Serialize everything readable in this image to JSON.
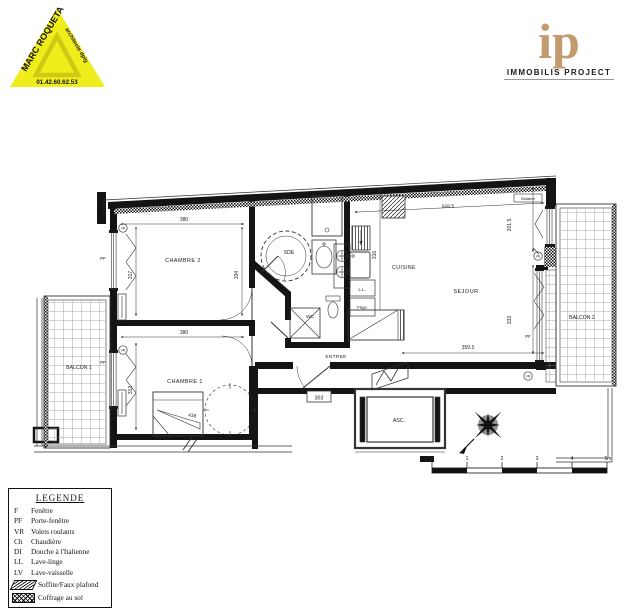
{
  "logos": {
    "architect": {
      "name": "MARC ROQUETA",
      "title": "architecte dplg",
      "phone": "01.42.60.62.53"
    },
    "agency": {
      "monogram": "ip",
      "name": "IMMOBILIS PROJECT"
    }
  },
  "plan": {
    "rooms": {
      "chambre2": "CHAMBRE 2",
      "chambre1": "CHAMBRE 1",
      "sde": "SDE",
      "cuisine": "CUISINE",
      "sejour": "SEJOUR",
      "balcon1": "BALCON 1",
      "balcon2": "BALCON 2",
      "wc": "WC",
      "entree": "ENTREE",
      "asc": "ASC."
    },
    "labels": {
      "pf": "PF",
      "vr": "VR",
      "ll": "L.L.",
      "frigo": "Frigo",
      "radiator": "Radiateur",
      "unit_number": "303"
    },
    "dims": {
      "c2w": "380",
      "c2hl": "317",
      "c2hr": "334",
      "c1w": "380",
      "c1h": "312",
      "c1diag": "438",
      "sj_top": "559.5",
      "sj_right_top": "201.5",
      "cuis_h": "316",
      "sj_right_bot": "333",
      "sj_bot": "359.5"
    }
  },
  "legend": {
    "title": "LEGENDE",
    "items": [
      {
        "abbr": "F",
        "label": "Fenêtre"
      },
      {
        "abbr": "PF",
        "label": "Porte-fenêtre"
      },
      {
        "abbr": "VR",
        "label": "Volets roulants"
      },
      {
        "abbr": "Ch",
        "label": "Chaudière"
      },
      {
        "abbr": "DI",
        "label": "Douche à l'Italienne"
      },
      {
        "abbr": "LL",
        "label": "Lave-linge"
      },
      {
        "abbr": "LV",
        "label": "Lave-vaisselle"
      }
    ],
    "hatches": [
      {
        "label": "Soffite/Faux plafond"
      },
      {
        "label": "Coffrage au sol"
      }
    ]
  },
  "scalebar": {
    "ticks": [
      "0",
      "1",
      "2",
      "3",
      "4",
      "5m"
    ]
  },
  "colors": {
    "triangle_yellow": "#f0ed1c",
    "monogram_tan": "#c49b6f"
  }
}
